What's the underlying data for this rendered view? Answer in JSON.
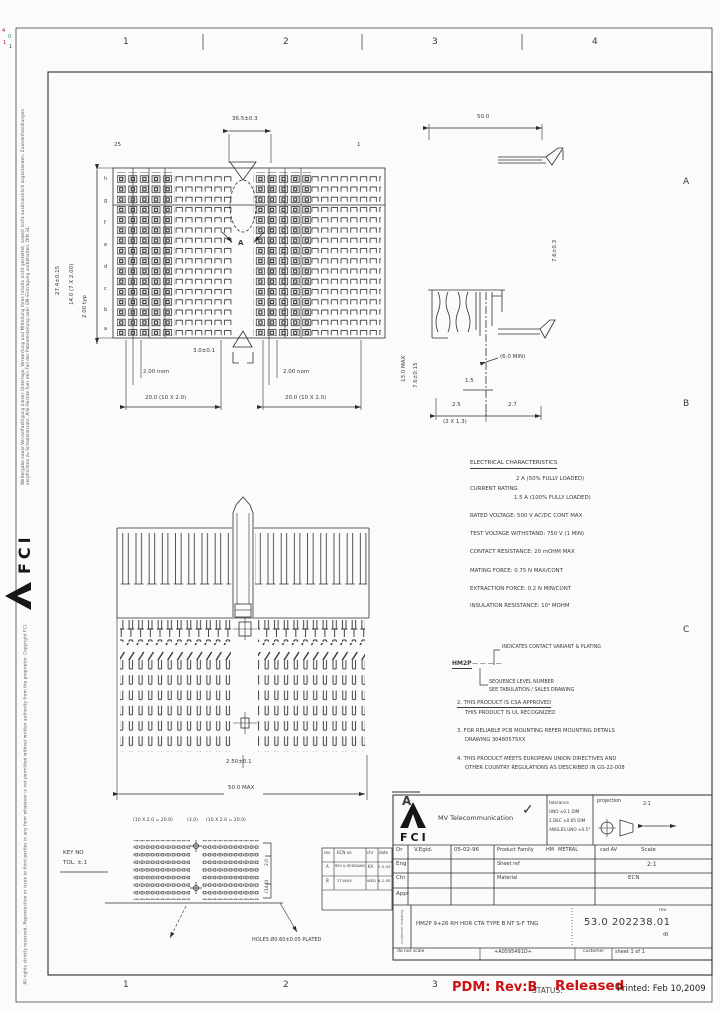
{
  "page": {
    "bg": "#fcfbfb",
    "ink": "#2e2e2e",
    "red": "#cc1111"
  },
  "margins": {
    "top_numbers": [
      "1",
      "2",
      "3",
      "4"
    ],
    "bottom_numbers": [
      "1",
      "2",
      "3"
    ],
    "right_letters": [
      "A",
      "B",
      "C"
    ],
    "specks": [
      "4",
      "0",
      "1",
      "1"
    ],
    "copyright_top": "Weitergabe sowie Vervielfaeltigung dieser Unterlage, Verwertung und Mitteilung ihres Inhalts nicht gestattet, soweit nicht ausdruecklich zugestanden. Zuwiderhandlungen verpflichten zu Schadenersatz. Alle Rechte fuer den Fall der Patenterteilung oder GM-Eintragung vorbehalten. DIN 34.",
    "copyright_bottom": "All rights strictly reserved. Reproduction or issue to third parties in any form whatever is not permitted without written authority from the proprietor. Copyright FCI.",
    "logo_text": "FCI"
  },
  "top_view": {
    "labels": [
      {
        "t": "36.5±0.3",
        "x": 232,
        "y": 117
      },
      {
        "t": "25",
        "x": 114,
        "y": 143
      },
      {
        "t": "1",
        "x": 357,
        "y": 143
      },
      {
        "t": "A",
        "x": 238,
        "y": 240,
        "s": 7,
        "b": 1
      },
      {
        "t": "h",
        "x": 104,
        "y": 177,
        "s": 5
      },
      {
        "t": "g",
        "x": 104,
        "y": 199,
        "s": 5
      },
      {
        "t": "f",
        "x": 104,
        "y": 221,
        "s": 5
      },
      {
        "t": "e",
        "x": 104,
        "y": 243,
        "s": 5
      },
      {
        "t": "d",
        "x": 104,
        "y": 265,
        "s": 5
      },
      {
        "t": "c",
        "x": 104,
        "y": 287,
        "s": 5
      },
      {
        "t": "b",
        "x": 104,
        "y": 308,
        "s": 5
      },
      {
        "t": "a",
        "x": 104,
        "y": 327,
        "s": 5
      },
      {
        "t": "27.4±0.15",
        "x": 56,
        "y": 295,
        "r": -90
      },
      {
        "t": "14.0 (7 X 2.00)",
        "x": 70,
        "y": 305,
        "r": -90
      },
      {
        "t": "2.00 typ",
        "x": 83,
        "y": 318,
        "r": -90
      },
      {
        "t": "3.0±0.1",
        "x": 193,
        "y": 349
      },
      {
        "t": "2.00 nom",
        "x": 143,
        "y": 370
      },
      {
        "t": "2.00 nom",
        "x": 283,
        "y": 370
      },
      {
        "t": "20.0 (10 X 2.0)",
        "x": 145,
        "y": 396
      },
      {
        "t": "20.0 (10 X 2.0)",
        "x": 285,
        "y": 396
      }
    ]
  },
  "side_view": {
    "labels": [
      {
        "t": "50.0",
        "x": 477,
        "y": 115
      },
      {
        "t": "7.6±0.3",
        "x": 553,
        "y": 262,
        "r": -90
      },
      {
        "t": "13.0 MAX",
        "x": 402,
        "y": 382,
        "r": -90
      },
      {
        "t": "7.6±0.15",
        "x": 414,
        "y": 388,
        "r": -90
      },
      {
        "t": "(6.0 MIN)",
        "x": 500,
        "y": 355
      },
      {
        "t": "1.5",
        "x": 465,
        "y": 379
      },
      {
        "t": "2.5",
        "x": 452,
        "y": 403
      },
      {
        "t": "2.7",
        "x": 508,
        "y": 403
      },
      {
        "t": "(2 X 1.3)",
        "x": 443,
        "y": 420
      }
    ]
  },
  "front_view": {
    "labels": [
      {
        "t": "2.50±0.1",
        "x": 226,
        "y": 760
      },
      {
        "t": "50.0 MAX",
        "x": 228,
        "y": 786
      },
      {
        "t": "A",
        "x": 402,
        "y": 795,
        "s": 12,
        "b": 1
      }
    ]
  },
  "pcb": {
    "labels": [
      {
        "t": "(10 X 2.0 = 20.0)",
        "x": 133,
        "y": 819,
        "s": 4.6
      },
      {
        "t": "(3.0)",
        "x": 187,
        "y": 819,
        "s": 4.6
      },
      {
        "t": "(10 X 2.0 = 20.0)",
        "x": 206,
        "y": 819,
        "s": 4.6
      },
      {
        "t": "KEY NO",
        "x": 63,
        "y": 851,
        "s": 5.5
      },
      {
        "t": "TOL. ±.1",
        "x": 63,
        "y": 861,
        "s": 5.5
      },
      {
        "t": "2.0",
        "x": 266,
        "y": 866,
        "s": 4.5,
        "r": -90
      },
      {
        "t": "(14.0)",
        "x": 266,
        "y": 893,
        "s": 4.5,
        "r": -90
      },
      {
        "t": "HOLES Ø0.60±0.05 PLATED",
        "x": 252,
        "y": 938,
        "s": 5
      }
    ]
  },
  "electrical": {
    "title": "ELECTRICAL CHARACTERISTICS",
    "current_label": "CURRENT RATING",
    "current_v1": "2 A (50% FULLY LOADED)",
    "current_v2": "1.5 A (100% FULLY LOADED)",
    "lines": [
      "RATED VOLTAGE: 500 V AC/DC CONT MAX",
      "TEST VOLTAGE WITHSTAND: 750 V (1 MIN)",
      "CONTACT RESISTANCE: 20 mOHM MAX",
      "MATING FORCE: 0.75 N MAX/CONT",
      "EXTRACTION FORCE: 0.2 N MIN/CONT",
      "INSULATION RESISTANCE: 10⁴ MOHM"
    ]
  },
  "part_key": {
    "stem": "HM2P",
    "dashes": "— — — —",
    "top_note": "INDICATES CONTACT VARIANT & PLATING",
    "seq_note_1": "SEQUENCE LEVEL NUMBER",
    "seq_note_2": "SEE TABULATION / SALES DRAWING"
  },
  "notes": {
    "n2a": "2. THIS PRODUCT IS CSA APPROVED",
    "n2b": "THIS PRODUCT IS UL RECOGNIZED",
    "n3a": "3. FOR RELIABLE PCB MOUNTING REFER MOUNTING DETAILS",
    "n3b": "DRAWING 30480575XX",
    "n4a": "4. THIS PRODUCT MEETS EUROPEAN UNION DIRECTIVES AND",
    "n4b": "OTHER COUNTRY REGULATIONS AS DESCRIBED IN GS-22-008"
  },
  "revision_table": {
    "headers": [
      "rev",
      "ECN no",
      "chr",
      "date"
    ],
    "rows": [
      [
        "A",
        "REV & REDRAWN",
        "KA",
        "7-5-03"
      ],
      [
        "B",
        "77160X",
        "WSD",
        "6-1-05"
      ]
    ]
  },
  "title_block": {
    "logo_text": "FCI",
    "company": "MV Telecommunication",
    "check": "✓",
    "tol1": "tolerance",
    "tol2": "UNO ±0.1 DIM",
    "tol3": "2 DEC ±0.05 DIM",
    "tol4": "ANGLES UNO ±0.5°",
    "projection_label": "projection",
    "ratio_note": "2:1",
    "dr_label": "Dr",
    "dr_name": "V.Egid.",
    "dr_date": "05-02-96",
    "eng_label": "Eng",
    "chr_label": "Chr",
    "appr_label": "Appr",
    "family_label": "Product Family",
    "family_v1": "HM",
    "family_v2": "METRAL",
    "sheetref_label": "Sheet ref",
    "material_label": "Material",
    "cad_label": "cad AV",
    "scale_label": "Scale",
    "scale_value": "2:1",
    "ecn_label": "ECN",
    "doc_type_vertical": "customer drawing",
    "description": "HM2P 9+26 RH HDR CTA TYPE B NT S-F TNG",
    "number": "53.0 202238.01",
    "rev_label": "rev",
    "rev_value": "B",
    "no_scale": "do not scale",
    "code": "+A0595491D+",
    "customer_label": "customer",
    "sheet_label": "sheet 1 of 1"
  },
  "status_bar": {
    "pdm": "PDM: Rev:B",
    "status_label": "STATUS:",
    "status_value": "Released",
    "printed": "Printed: Feb 10,2009"
  }
}
